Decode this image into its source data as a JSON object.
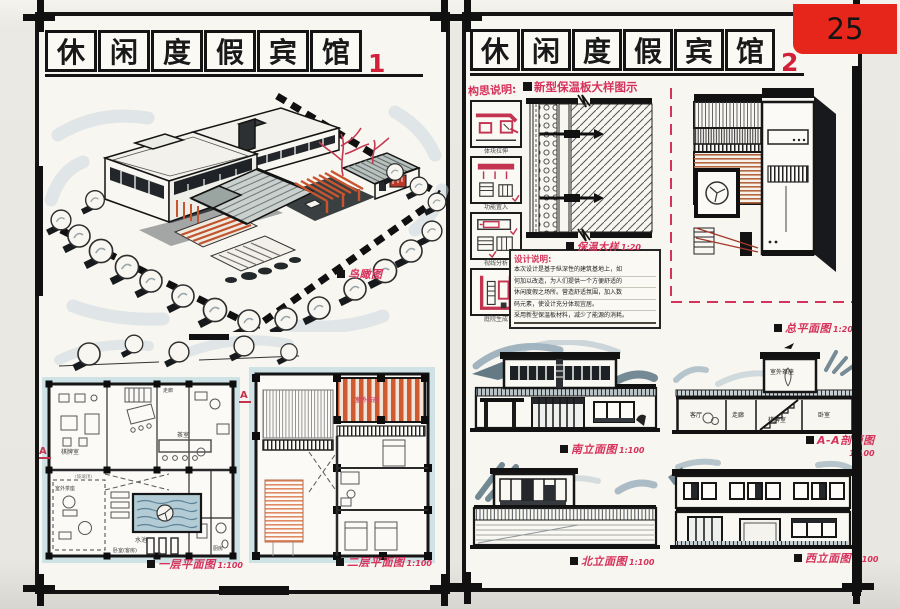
{
  "page": {
    "badge_number": "25"
  },
  "sheet1": {
    "title_chars": [
      "休",
      "闲",
      "度",
      "假",
      "宾",
      "馆"
    ],
    "sheet_no": "1",
    "birdseye_label": "鸟瞰图",
    "plan1_label": "一层平面图",
    "plan1_scale": "1:100",
    "plan2_label": "二层平面图",
    "plan2_scale": "1:100",
    "section_marker": "A",
    "plan1_rooms": {
      "qipai": "棋牌室",
      "corridor": "走廊",
      "tea": "茶室",
      "pool": "水池",
      "outdoor_tea": "室外茶座",
      "glass_roof": "(玻璃顶)",
      "bedroom": "卧室(客房)",
      "kitchen": "厨房"
    },
    "plan2_rooms": {
      "outdoor_tea": "室外茶座"
    }
  },
  "sheet2": {
    "title_chars": [
      "休",
      "闲",
      "度",
      "假",
      "宾",
      "馆"
    ],
    "sheet_no": "2",
    "concept_title": "构思说明:",
    "concept_captions": [
      "体块拉伸",
      "功能置入",
      "视线分析",
      "庭院生成"
    ],
    "detail_title": "新型保温板大样图示",
    "detail_label": "保温大样",
    "detail_scale": "1:20",
    "notes_title": "设计说明:",
    "notes_lines": [
      "本次设计是基于纵深性的建筑基地上，如",
      "何加以改造，为人们提供一个方便舒适的",
      "休闲度假之场所。营造舒适氛围，加入数",
      "码元素，使设计充分体现宜居。",
      "采用新型保温板材料，减少了能源的消耗。"
    ],
    "site_label": "总平面图",
    "site_scale": "1:200",
    "south_label": "南立面图",
    "south_scale": "1:100",
    "section_label": "A-A剖面图",
    "section_scale": "1:100",
    "north_label": "北立面图",
    "north_scale": "1:100",
    "west_label": "西立面图",
    "west_scale": "1:100",
    "section_rooms": [
      "室外茶座",
      "客厅",
      "走廊",
      "棋牌室",
      "卧室"
    ]
  },
  "colors": {
    "ink": "#161616",
    "red_label": "#d6335c",
    "red_number": "#d2203a",
    "badge_red": "#e7261b",
    "accent_orange": "#c8552e",
    "marker_blue": "#8ba4b3",
    "plan_cyan": "#cfe3e6"
  }
}
